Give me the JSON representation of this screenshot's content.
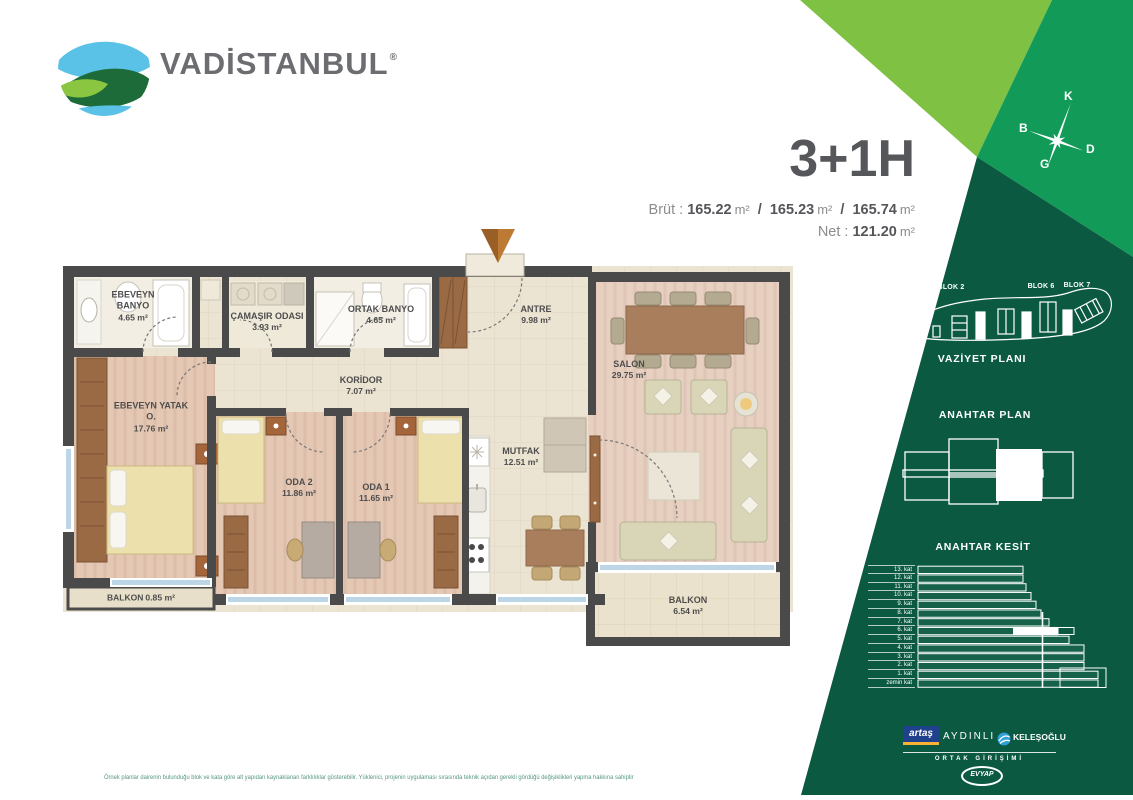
{
  "brand": {
    "name": "VADİSTANBUL",
    "registered": "®"
  },
  "header": {
    "title": "3+1H",
    "brut_label": "Brüt :",
    "brut_1": "165.22",
    "brut_2": "165.23",
    "brut_3": "165.74",
    "net_label": "Net :",
    "net_value": "121.20",
    "unit": "m²",
    "slash": "/"
  },
  "compass": {
    "north": "K",
    "west": "B",
    "east": "D",
    "south": "G"
  },
  "site_plan": {
    "title": "VAZİYET PLANI",
    "blocks": [
      "BLOK 2",
      "BLOK 4",
      "BLOK 6",
      "BLOK 7"
    ]
  },
  "key_plan": {
    "title": "ANAHTAR PLAN"
  },
  "key_section": {
    "title": "ANAHTAR KESİT",
    "highlighted_floor": "6. kat",
    "floors": [
      {
        "label": "13. kat",
        "w": 105
      },
      {
        "label": "12. kat",
        "w": 105
      },
      {
        "label": "11. kat",
        "w": 108
      },
      {
        "label": "10. kat",
        "w": 113
      },
      {
        "label": "9. kat",
        "w": 118
      },
      {
        "label": "8. kat",
        "w": 123
      },
      {
        "label": "7. kat",
        "w": 131
      },
      {
        "label": "6. kat",
        "w": 140,
        "hl": [
          95,
          45
        ]
      },
      {
        "label": "5. kat",
        "w": 151
      },
      {
        "label": "4. kat",
        "w": 166
      },
      {
        "label": "3. kat",
        "w": 166
      },
      {
        "label": "2. kat",
        "w": 166
      },
      {
        "label": "1. kat",
        "w": 180
      },
      {
        "label": "zemin kat",
        "w": 180
      }
    ]
  },
  "plan": {
    "rooms": [
      {
        "name": "EBEVEYN BANYO",
        "area": "4.65 m²"
      },
      {
        "name": "ÇAMAŞIR ODASI",
        "area": "3.93 m²"
      },
      {
        "name": "ORTAK BANYO",
        "area": "4.65 m²"
      },
      {
        "name": "ANTRE",
        "area": "9.98 m²"
      },
      {
        "name": "SALON",
        "area": "29.75 m²"
      },
      {
        "name": "EBEVEYN YATAK O.",
        "area": "17.76 m²"
      },
      {
        "name": "KORİDOR",
        "area": "7.07 m²"
      },
      {
        "name": "ODA 2",
        "area": "11.86 m²"
      },
      {
        "name": "ODA 1",
        "area": "11.65 m²"
      },
      {
        "name": "MUTFAK",
        "area": "12.51 m²"
      },
      {
        "name": "BALKON",
        "area": "0.85 m²"
      },
      {
        "name": "BALKON",
        "area": "6.54 m²"
      }
    ]
  },
  "partners": {
    "artas": "artaş",
    "aydinli": "AYDINLI",
    "kelesoglu": "KELEŞOĞLU",
    "joint_venture": "ORTAK GİRİŞİMİ",
    "evyap": "EVYAP"
  },
  "footer": {
    "disclaimer": "Örnek planlar dairenin bulunduğu blok ve kata göre alt yapıdan kaynaklanan farklılıklar gösterebilir. Yüklenici, projenin uygulaması sırasında teknik açıdan gerekli gördüğü değişiklikleri yapma hakkına sahiptir"
  },
  "colors": {
    "light_green": "#7fc143",
    "mid_green": "#129b58",
    "dark_green": "#0a5940",
    "accent_orange": "#b06f2e"
  }
}
